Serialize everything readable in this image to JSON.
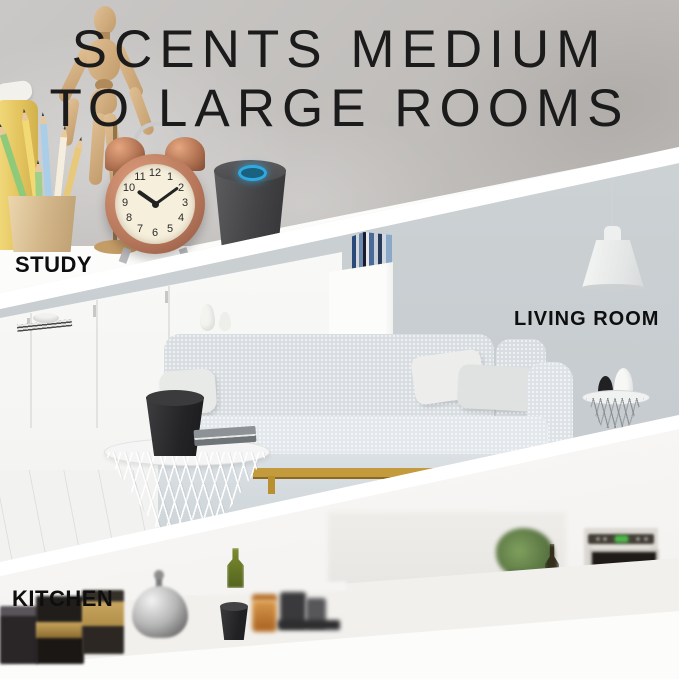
{
  "headline": {
    "line1": "SCENTS MEDIUM",
    "line2": "TO LARGE ROOMS"
  },
  "labels": {
    "study": "STUDY",
    "living_room": "LIVING ROOM",
    "kitchen": "KITCHEN"
  },
  "clock": {
    "time": "10:09",
    "numerals": [
      "12",
      "1",
      "2",
      "3",
      "4",
      "5",
      "6",
      "7",
      "8",
      "9",
      "10",
      "11"
    ]
  },
  "colors": {
    "headline_text": "#1b1b1b",
    "label_text": "#0e0e0e",
    "diffuser_ring_blue": "#2fa9e0",
    "clock_copper": "#b5765a",
    "sofa_frame_gold": "#c39a3c",
    "oven_led_green": "#4db84a",
    "study_wall_gray": "#c4c1be",
    "living_wall_gray": "#c7cdd0",
    "kitchen_white": "#f8f7f5"
  }
}
